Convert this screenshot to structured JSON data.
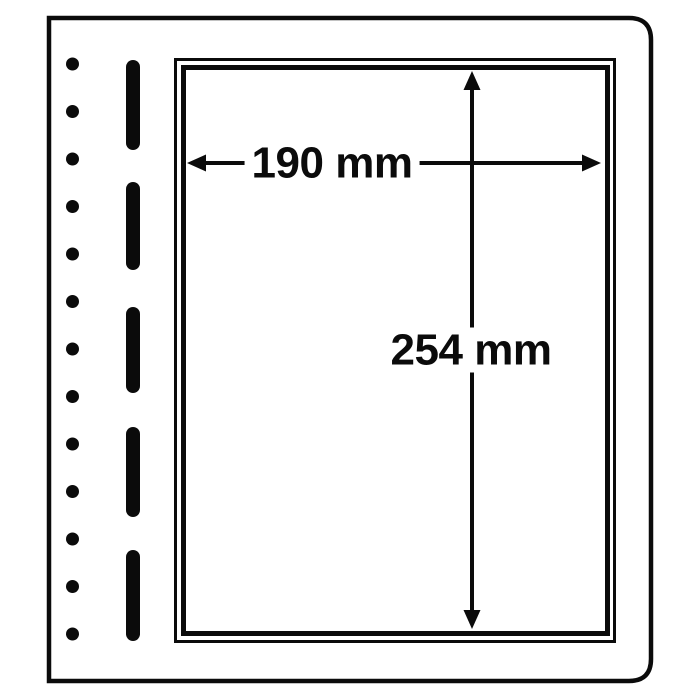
{
  "diagram": {
    "background_color": "#ffffff",
    "ink_color": "#0b0b0b",
    "dimensions": {
      "width_label": "190 mm",
      "height_label": "254 mm"
    },
    "binding": {
      "hole_count": 13,
      "slot_count": 5
    }
  }
}
